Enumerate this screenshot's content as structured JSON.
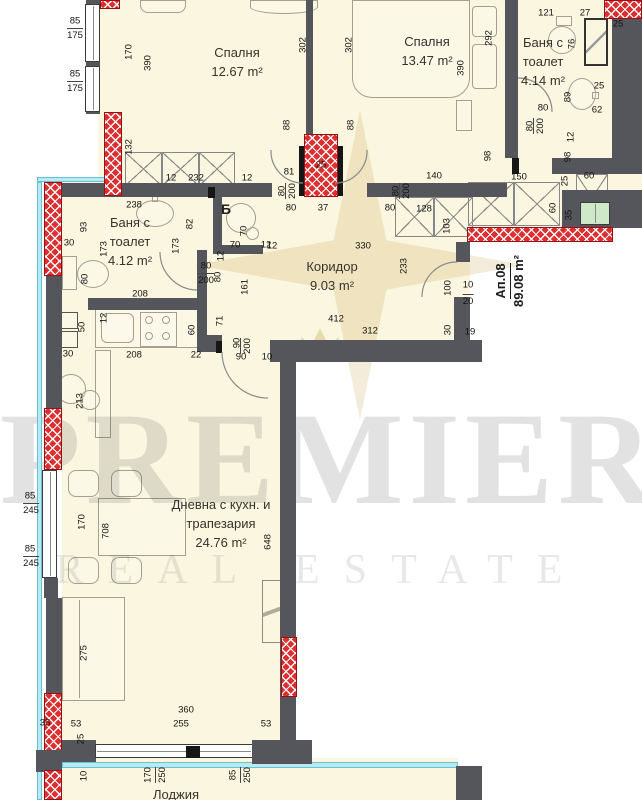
{
  "watermark": {
    "brand_top": "PREMIER",
    "brand_bottom": "REAL ESTATE"
  },
  "apartment": {
    "id": "Ап.08",
    "area": "89.08 m²"
  },
  "section_marker": "Б",
  "colors": {
    "floor": "#faf6df",
    "wall": "#55555c",
    "hatch_red": "#dd2f2f",
    "insulation_cyan": "#b9e9f2",
    "window_green": "#cde9c8",
    "watermark_gold": "#c6a244"
  },
  "rooms": [
    {
      "id": "bedroom-1",
      "lines": [
        "Спалня",
        "12.67 m²"
      ],
      "x": 237,
      "y": 44
    },
    {
      "id": "bedroom-2",
      "lines": [
        "Спалня",
        "13.47 m²"
      ],
      "x": 427,
      "y": 33
    },
    {
      "id": "bathroom-top",
      "lines": [
        "Баня с",
        "тоалет",
        "4.14 m²"
      ],
      "x": 543,
      "y": 34
    },
    {
      "id": "bathroom-left",
      "lines": [
        "Баня с",
        "тоалет",
        "4.12 m²"
      ],
      "x": 130,
      "y": 214
    },
    {
      "id": "corridor",
      "lines": [
        "Коридор",
        "9.03 m²"
      ],
      "x": 332,
      "y": 258
    },
    {
      "id": "living-room",
      "lines": [
        "Дневна с кухн. и",
        "трапезария",
        "24.76 m²"
      ],
      "x": 221,
      "y": 496
    },
    {
      "id": "balcony",
      "lines": [
        "Лоджия"
      ],
      "x": 176,
      "y": 786
    }
  ],
  "dimensions": [
    {
      "t": "85",
      "x": 75,
      "y": 21
    },
    {
      "t": "175",
      "x": 75,
      "y": 34,
      "u": 1
    },
    {
      "t": "85",
      "x": 75,
      "y": 74
    },
    {
      "t": "175",
      "x": 75,
      "y": 87,
      "u": 1
    },
    {
      "t": "170",
      "x": 129,
      "y": 52,
      "v": 1
    },
    {
      "t": "390",
      "x": 148,
      "y": 63,
      "v": 1
    },
    {
      "t": "302",
      "x": 303,
      "y": 45,
      "v": 1
    },
    {
      "t": "302",
      "x": 349,
      "y": 45,
      "v": 1
    },
    {
      "t": "292",
      "x": 489,
      "y": 38,
      "v": 1
    },
    {
      "t": "390",
      "x": 461,
      "y": 68,
      "v": 1
    },
    {
      "t": "132",
      "x": 129,
      "y": 147,
      "v": 1
    },
    {
      "t": "12",
      "x": 171,
      "y": 178
    },
    {
      "t": "232",
      "x": 196,
      "y": 178
    },
    {
      "t": "12",
      "x": 247,
      "y": 178
    },
    {
      "t": "88",
      "x": 287,
      "y": 125,
      "v": 1
    },
    {
      "t": "88",
      "x": 351,
      "y": 125,
      "v": 1
    },
    {
      "t": "81",
      "x": 289,
      "y": 172
    },
    {
      "t": "25",
      "x": 321,
      "y": 165
    },
    {
      "t": "80",
      "x": 282,
      "y": 191,
      "v": 1
    },
    {
      "t": "200",
      "x": 291,
      "y": 191,
      "v": 1,
      "u": 1
    },
    {
      "t": "80",
      "x": 396,
      "y": 191,
      "v": 1
    },
    {
      "t": "200",
      "x": 405,
      "y": 191,
      "v": 1,
      "u": 1
    },
    {
      "t": "80",
      "x": 291,
      "y": 208
    },
    {
      "t": "37",
      "x": 323,
      "y": 208
    },
    {
      "t": "80",
      "x": 390,
      "y": 208
    },
    {
      "t": "140",
      "x": 434,
      "y": 176
    },
    {
      "t": "128",
      "x": 424,
      "y": 209
    },
    {
      "t": "103",
      "x": 447,
      "y": 226,
      "v": 1
    },
    {
      "t": "121",
      "x": 546,
      "y": 13
    },
    {
      "t": "27",
      "x": 585,
      "y": 13
    },
    {
      "t": "25",
      "x": 618,
      "y": 24
    },
    {
      "t": "76",
      "x": 572,
      "y": 44,
      "v": 1
    },
    {
      "t": "25",
      "x": 599,
      "y": 86
    },
    {
      "t": "89",
      "x": 568,
      "y": 97,
      "v": 1
    },
    {
      "t": "62",
      "x": 597,
      "y": 110
    },
    {
      "t": "80",
      "x": 543,
      "y": 108
    },
    {
      "t": "80",
      "x": 530,
      "y": 126,
      "v": 1
    },
    {
      "t": "200",
      "x": 539,
      "y": 126,
      "v": 1,
      "u": 1
    },
    {
      "t": "12",
      "x": 571,
      "y": 137,
      "v": 1
    },
    {
      "t": "98",
      "x": 488,
      "y": 156,
      "v": 1
    },
    {
      "t": "98",
      "x": 568,
      "y": 157,
      "v": 1
    },
    {
      "t": "150",
      "x": 519,
      "y": 177
    },
    {
      "t": "25",
      "x": 565,
      "y": 181,
      "v": 1
    },
    {
      "t": "60",
      "x": 589,
      "y": 176
    },
    {
      "t": "60",
      "x": 553,
      "y": 208,
      "v": 1
    },
    {
      "t": "35",
      "x": 569,
      "y": 215,
      "v": 1
    },
    {
      "t": "238",
      "x": 134,
      "y": 205
    },
    {
      "t": "93",
      "x": 84,
      "y": 227,
      "v": 1
    },
    {
      "t": "30",
      "x": 69,
      "y": 243
    },
    {
      "t": "173",
      "x": 104,
      "y": 249,
      "v": 1
    },
    {
      "t": "82",
      "x": 190,
      "y": 224,
      "v": 1
    },
    {
      "t": "173",
      "x": 176,
      "y": 246,
      "v": 1
    },
    {
      "t": "70",
      "x": 244,
      "y": 231,
      "v": 1
    },
    {
      "t": "70",
      "x": 235,
      "y": 245
    },
    {
      "t": "12",
      "x": 266,
      "y": 245
    },
    {
      "t": "80",
      "x": 85,
      "y": 279,
      "v": 1
    },
    {
      "t": "208",
      "x": 140,
      "y": 294
    },
    {
      "t": "12",
      "x": 221,
      "y": 256,
      "v": 1
    },
    {
      "t": "80",
      "x": 206,
      "y": 266
    },
    {
      "t": "200",
      "x": 206,
      "y": 279,
      "u": 1
    },
    {
      "t": "80",
      "x": 218,
      "y": 277,
      "v": 1
    },
    {
      "t": "161",
      "x": 245,
      "y": 287,
      "v": 1
    },
    {
      "t": "12",
      "x": 272,
      "y": 246
    },
    {
      "t": "330",
      "x": 363,
      "y": 246
    },
    {
      "t": "233",
      "x": 404,
      "y": 266,
      "v": 1
    },
    {
      "t": "100",
      "x": 448,
      "y": 288,
      "v": 1
    },
    {
      "t": "10",
      "x": 468,
      "y": 285
    },
    {
      "t": "20",
      "x": 468,
      "y": 300,
      "u": 1
    },
    {
      "t": "412",
      "x": 336,
      "y": 319
    },
    {
      "t": "312",
      "x": 370,
      "y": 331
    },
    {
      "t": "30",
      "x": 448,
      "y": 330,
      "v": 1
    },
    {
      "t": "19",
      "x": 470,
      "y": 332
    },
    {
      "t": "90",
      "x": 237,
      "y": 343,
      "v": 1
    },
    {
      "t": "200",
      "x": 246,
      "y": 346,
      "v": 1,
      "u": 1
    },
    {
      "t": "90",
      "x": 241,
      "y": 357
    },
    {
      "t": "10",
      "x": 267,
      "y": 357
    },
    {
      "t": "30",
      "x": 68,
      "y": 354
    },
    {
      "t": "208",
      "x": 134,
      "y": 355
    },
    {
      "t": "22",
      "x": 196,
      "y": 355
    },
    {
      "t": "12",
      "x": 104,
      "y": 318,
      "v": 1
    },
    {
      "t": "50",
      "x": 82,
      "y": 327,
      "v": 1
    },
    {
      "t": "60",
      "x": 192,
      "y": 330,
      "v": 1
    },
    {
      "t": "71",
      "x": 220,
      "y": 321,
      "v": 1
    },
    {
      "t": "213",
      "x": 80,
      "y": 401,
      "v": 1
    },
    {
      "t": "85",
      "x": 30,
      "y": 496
    },
    {
      "t": "245",
      "x": 31,
      "y": 509,
      "u": 1
    },
    {
      "t": "85",
      "x": 30,
      "y": 549
    },
    {
      "t": "245",
      "x": 31,
      "y": 562,
      "u": 1
    },
    {
      "t": "170",
      "x": 82,
      "y": 522,
      "v": 1
    },
    {
      "t": "708",
      "x": 106,
      "y": 531,
      "v": 1
    },
    {
      "t": "648",
      "x": 268,
      "y": 542,
      "v": 1
    },
    {
      "t": "275",
      "x": 84,
      "y": 653,
      "v": 1
    },
    {
      "t": "360",
      "x": 186,
      "y": 710
    },
    {
      "t": "53",
      "x": 76,
      "y": 724
    },
    {
      "t": "255",
      "x": 181,
      "y": 724
    },
    {
      "t": "53",
      "x": 266,
      "y": 724
    },
    {
      "t": "25",
      "x": 81,
      "y": 739,
      "v": 1
    },
    {
      "t": "35",
      "x": 45,
      "y": 723
    },
    {
      "t": "10",
      "x": 84,
      "y": 776,
      "v": 1
    },
    {
      "t": "170",
      "x": 148,
      "y": 775,
      "v": 1
    },
    {
      "t": "250",
      "x": 161,
      "y": 775,
      "v": 1,
      "u": 1
    },
    {
      "t": "85",
      "x": 233,
      "y": 775,
      "v": 1
    },
    {
      "t": "250",
      "x": 246,
      "y": 775,
      "v": 1,
      "u": 1
    }
  ]
}
